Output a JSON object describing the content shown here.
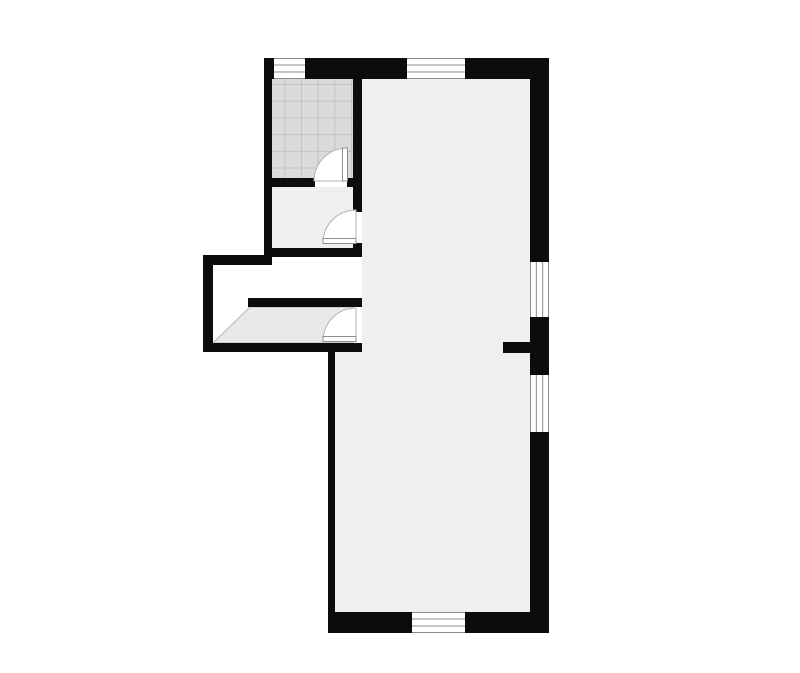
{
  "canvas": {
    "width": 800,
    "height": 673
  },
  "colors": {
    "background": "#ffffff",
    "wall": "#0c0c0c",
    "room_floor": "#efefef",
    "porch_floor": "#e9e9e9",
    "porch_outline": "#b5b5b5",
    "tile_fill": "#dbdbdb",
    "tile_grid": "#c3c3c3",
    "window_fill": "#ffffff",
    "window_frame": "#8c8c8c",
    "door_fill": "#ffffff",
    "door_swing_stroke": "#b3b3b3",
    "door_leaf_stroke": "#8f8f8f"
  },
  "plan": {
    "floors": [
      {
        "name": "main-room-floor",
        "shape": "polygon",
        "points": "362,79 530,79 530,613 335,613 335,352 362,352",
        "fill": "room_floor"
      },
      {
        "name": "small-room-floor",
        "shape": "rect",
        "x": 272,
        "y": 187,
        "w": 81,
        "h": 61,
        "fill": "room_floor"
      },
      {
        "name": "porch-floor",
        "shape": "polygon",
        "points": "250,307 353,307 353,343 213,343",
        "fill": "porch_floor",
        "stroke": "porch_outline"
      },
      {
        "name": "tiled-room-floor",
        "shape": "rect",
        "x": 272,
        "y": 79,
        "w": 81,
        "h": 99,
        "fill": "tiles"
      }
    ],
    "walls": [
      {
        "name": "north-wall",
        "x": 264,
        "y": 58,
        "w": 285,
        "h": 21
      },
      {
        "name": "east-wall",
        "x": 530,
        "y": 58,
        "w": 19,
        "h": 575
      },
      {
        "name": "south-wall",
        "x": 328,
        "y": 612,
        "w": 221,
        "h": 21
      },
      {
        "name": "west-upper-wall",
        "x": 264,
        "y": 58,
        "w": 8,
        "h": 207
      },
      {
        "name": "tiled-room-south-wall",
        "x": 264,
        "y": 178,
        "w": 51,
        "h": 9
      },
      {
        "name": "tiled-room-south-stub",
        "x": 347,
        "y": 178,
        "w": 15,
        "h": 9
      },
      {
        "name": "core-wall-upper",
        "x": 353,
        "y": 79,
        "w": 9,
        "h": 133
      },
      {
        "name": "core-wall-mid",
        "x": 353,
        "y": 243,
        "w": 9,
        "h": 14
      },
      {
        "name": "small-room-south-wall",
        "x": 264,
        "y": 248,
        "w": 98,
        "h": 9
      },
      {
        "name": "porch-north-wall",
        "x": 203,
        "y": 255,
        "w": 69,
        "h": 10
      },
      {
        "name": "porch-west-wall",
        "x": 203,
        "y": 255,
        "w": 10,
        "h": 97
      },
      {
        "name": "porch-south-wall",
        "x": 203,
        "y": 343,
        "w": 159,
        "h": 9
      },
      {
        "name": "porch-inner-wall",
        "x": 248,
        "y": 298,
        "w": 114,
        "h": 9
      },
      {
        "name": "lower-room-west-wall",
        "x": 328,
        "y": 343,
        "w": 7,
        "h": 270
      },
      {
        "name": "east-stub-wall",
        "x": 503,
        "y": 342,
        "w": 27,
        "h": 11
      }
    ],
    "windows": [
      {
        "name": "north-window-1",
        "x": 274,
        "y": 58,
        "w": 31,
        "h": 21,
        "orientation": "horizontal"
      },
      {
        "name": "north-window-2",
        "x": 407,
        "y": 58,
        "w": 58,
        "h": 21,
        "orientation": "horizontal"
      },
      {
        "name": "east-window-1",
        "x": 530,
        "y": 262,
        "w": 19,
        "h": 55,
        "orientation": "vertical"
      },
      {
        "name": "east-window-2",
        "x": 530,
        "y": 375,
        "w": 19,
        "h": 57,
        "orientation": "vertical"
      },
      {
        "name": "south-window",
        "x": 412,
        "y": 612,
        "w": 53,
        "h": 21,
        "orientation": "horizontal"
      }
    ],
    "doors": [
      {
        "name": "tiled-room-door",
        "swing": "M347,181 L347,148 A33,33 0 0 0 314,181 Z",
        "leaf": {
          "x": 342.5,
          "y": 148,
          "w": 5,
          "h": 33
        }
      },
      {
        "name": "small-room-door",
        "swing": "M356,243 L323,243 A33,33 0 0 1 356,210 Z",
        "leaf": {
          "x": 323,
          "y": 238.5,
          "w": 33,
          "h": 5
        }
      },
      {
        "name": "entry-door",
        "swing": "M356,341 L323,341 A33,33 0 0 1 356,308 Z",
        "leaf": {
          "x": 323,
          "y": 336.5,
          "w": 33,
          "h": 5
        }
      }
    ],
    "tile_pattern": {
      "size": 16.7,
      "offset_x": 268.6,
      "offset_y": 68.3
    }
  }
}
